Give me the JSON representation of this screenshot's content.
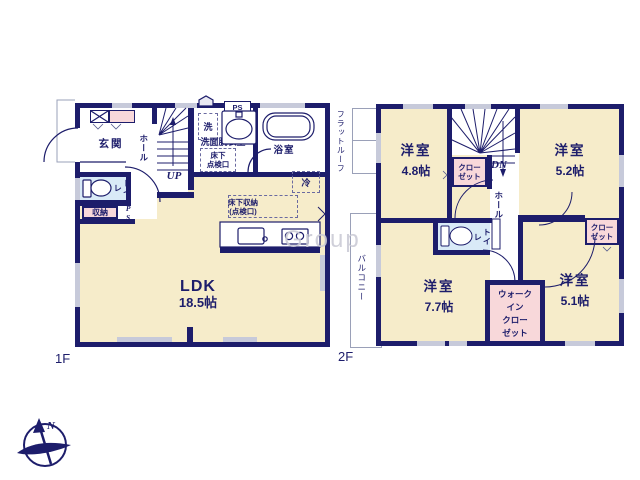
{
  "watermark": "Group",
  "compass": {
    "north": "N"
  },
  "colors": {
    "wall": "#1d1d6b",
    "room_fill": "#f6ecca",
    "closet_fill": "#f8d8da",
    "wet_fill": "#d9eaf7",
    "window": "#c7cada"
  },
  "floor1": {
    "label": "1F",
    "entrance": "玄関",
    "hall": "ホール",
    "toilet": "トイレ",
    "storage": "収納",
    "ps": "PS",
    "up": "UP",
    "washer": "洗",
    "washroom": "洗面脱衣室",
    "hatch_line1": "床下",
    "hatch_line2": "点検口",
    "bath": "浴室",
    "fridge": "冷",
    "floor_storage_line1": "床下収納",
    "floor_storage_line2": "(点検口)",
    "ldk": "LDK",
    "ldk_size": "18.5帖"
  },
  "floor2": {
    "label": "2F",
    "flat_roof": "フラットルーフ",
    "balcony": "バルコニー",
    "dn": "DN",
    "hall": "ホール",
    "toilet": "トイレ",
    "closet_line1": "クロー",
    "closet_line2": "ゼット",
    "wic_line1": "ウォーク",
    "wic_line2": "イン",
    "wic_line3": "クロー",
    "wic_line4": "ゼット",
    "room_nw": {
      "name": "洋室",
      "size": "4.8帖"
    },
    "room_ne": {
      "name": "洋室",
      "size": "5.2帖"
    },
    "room_sw": {
      "name": "洋室",
      "size": "7.7帖"
    },
    "room_se": {
      "name": "洋室",
      "size": "5.1帖"
    }
  }
}
